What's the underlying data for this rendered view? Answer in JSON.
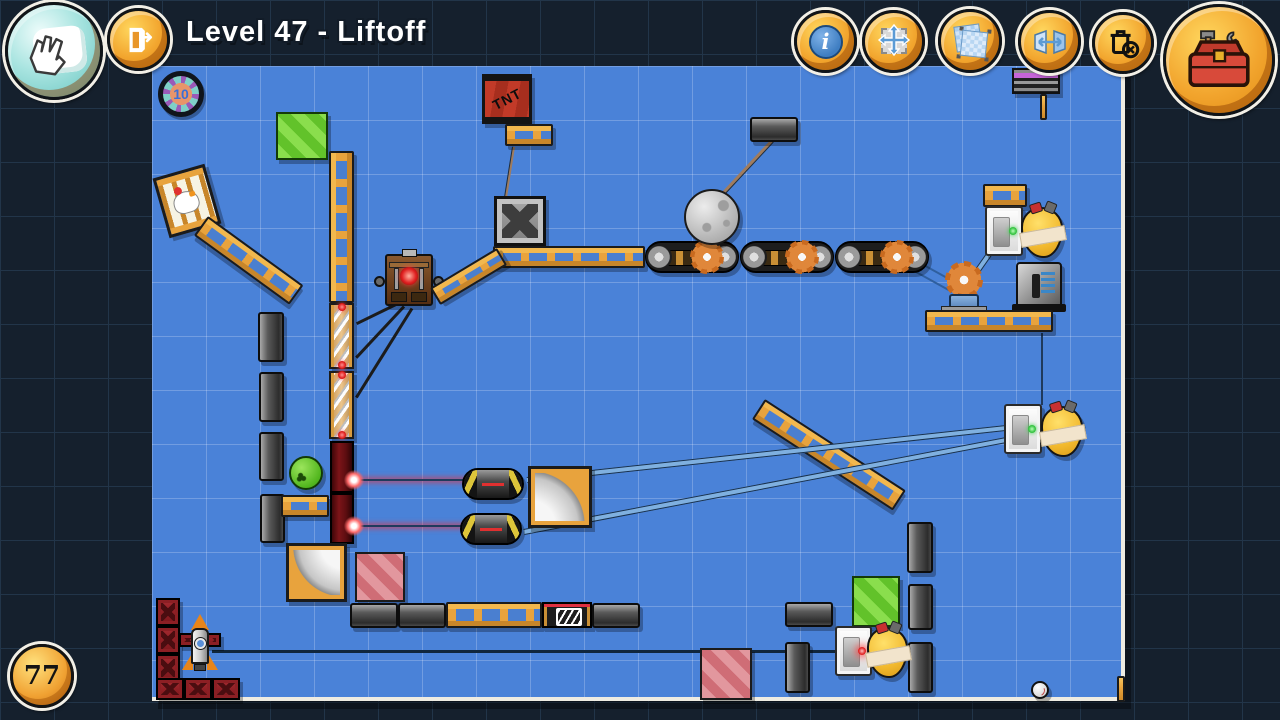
{
  "hud": {
    "level_title": "Level 47 - Liftoff",
    "parts_badge": "10",
    "solutions_badge": "77",
    "info_glyph": "i",
    "buttons": [
      {
        "id": "hand",
        "icon": "hand-pan-icon"
      },
      {
        "id": "exit",
        "icon": "door-exit-icon"
      },
      {
        "id": "info",
        "icon": "info-icon"
      },
      {
        "id": "move",
        "icon": "move-arrows-icon"
      },
      {
        "id": "select",
        "icon": "marquee-select-icon"
      },
      {
        "id": "flip",
        "icon": "flip-horizontal-icon"
      },
      {
        "id": "delete",
        "icon": "delete-parts-icon"
      },
      {
        "id": "toolbox",
        "icon": "toolbox-icon"
      }
    ]
  },
  "board": {
    "tnt_label": "TNT",
    "objects": [
      "chicken-cage",
      "green-striped-crate-1",
      "green-striped-crate-2",
      "tnt-crate",
      "steel-crate",
      "moon-ball",
      "conveyor-belt-segments",
      "conveyor-gears",
      "hanging-metal-plank",
      "wooden-ladder-planks",
      "metal-planks",
      "spring-tower",
      "laser-emitters",
      "laser-beams",
      "laser-receiver-capsules",
      "curved-ramp-left",
      "curved-ramp-right",
      "green-bowling-ball",
      "pink-striped-crate-1",
      "pink-striped-crate-2",
      "power-switch-1",
      "power-switch-2",
      "power-switch-3",
      "hive-creature-1",
      "hive-creature-2",
      "hive-creature-3",
      "electric-motor",
      "power-supply-box",
      "generator-machine",
      "tilted-ladder-left",
      "tilted-ladder-right",
      "rocket",
      "red-girder-blocks",
      "long-rope",
      "baseball",
      "striped-sign",
      "edge-stick"
    ]
  },
  "colors": {
    "background": "#15202d",
    "board_blue": "#4a82d8",
    "grid_line": "#6fa0e6",
    "accent_gold": "#f2a52e",
    "laser_red": "#ff2f2f",
    "wood": "#e8a33d",
    "girder_red": "#9c2228",
    "teal_button": "#a8e4e0"
  }
}
